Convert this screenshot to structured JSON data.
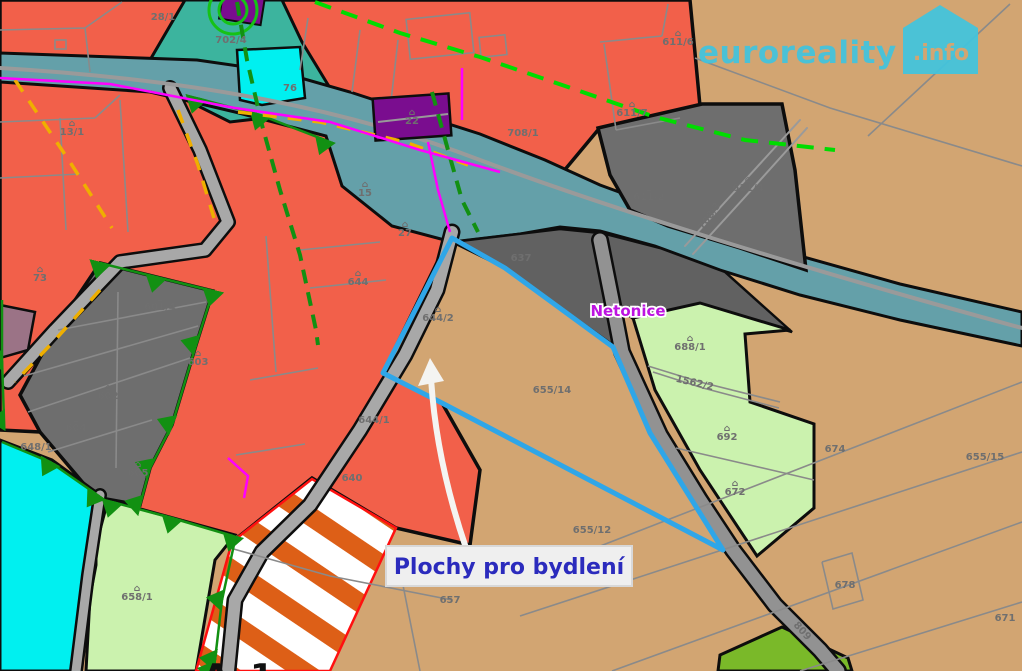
{
  "watermark": {
    "brand": "euroreality",
    "tld": ".info"
  },
  "annotation": {
    "area_label": "Plochy pro bydlení",
    "village_label": "Netonice",
    "zone_code_left": "A",
    "zone_code_right": "1"
  },
  "colors": {
    "housing_red": "#F2604A",
    "field_tan": "#D2A572",
    "gray_zone": "#6E6E6E",
    "stream_teal": "#64A0A9",
    "green_teal": "#3CB49E",
    "light_green": "#CBF2AE",
    "bright_cyan": "#00F0F0",
    "building_purple": "#7A0D8F",
    "lime_green": "#7AB929",
    "highlight_blue": "#2FA6E8",
    "hatch_orange": "#DD5F17",
    "annotation_blue": "#2B2BBD",
    "village_magenta": "#BD13E0",
    "logo_cyan": "#41C4DE"
  },
  "map_labels": [
    {
      "text": "28/1",
      "x": 163,
      "y": 20
    },
    {
      "text": "702/4",
      "x": 231,
      "y": 43,
      "fill": "#519B8C"
    },
    {
      "text": "13/1",
      "x": 72,
      "y": 135,
      "icon": true
    },
    {
      "text": "73",
      "x": 40,
      "y": 281,
      "icon": true
    },
    {
      "text": "76",
      "x": 290,
      "y": 91
    },
    {
      "text": "15",
      "x": 365,
      "y": 196,
      "icon": true
    },
    {
      "text": "27",
      "x": 405,
      "y": 236,
      "icon": true
    },
    {
      "text": "22",
      "x": 412,
      "y": 124,
      "icon": true,
      "fill": "#3d3d3d"
    },
    {
      "text": "708/1",
      "x": 523,
      "y": 136,
      "fill": "#8a8a8a"
    },
    {
      "text": "611/7",
      "x": 632,
      "y": 116,
      "icon": true
    },
    {
      "text": "611/6",
      "x": 678,
      "y": 45,
      "icon": true
    },
    {
      "text": "611/2",
      "x": 649,
      "y": 200,
      "icon": true,
      "fill": "#5d5d5d"
    },
    {
      "text": "611/4",
      "x": 748,
      "y": 191,
      "icon": true,
      "fill": "#5d5d5d"
    },
    {
      "text": "708/3",
      "x": 712,
      "y": 218,
      "rot": -55,
      "fill": "#5d5d5d"
    },
    {
      "text": "637",
      "x": 521,
      "y": 261,
      "fill": "#5d5d5d"
    },
    {
      "text": "644",
      "x": 358,
      "y": 285,
      "icon": true
    },
    {
      "text": "644/2",
      "x": 438,
      "y": 321,
      "icon": true
    },
    {
      "text": "644/1",
      "x": 374,
      "y": 423
    },
    {
      "text": "640",
      "x": 352,
      "y": 481
    },
    {
      "text": "648/1",
      "x": 36,
      "y": 450
    },
    {
      "text": "601/4",
      "x": 160,
      "y": 310,
      "icon": true,
      "fill": "#5d5d5d"
    },
    {
      "text": "603",
      "x": 198,
      "y": 365,
      "icon": true,
      "fill": "#5d5d5d"
    },
    {
      "text": "602",
      "x": 108,
      "y": 399,
      "icon": true,
      "fill": "#5d5d5d"
    },
    {
      "text": "604",
      "x": 76,
      "y": 431,
      "icon": true,
      "fill": "#5d5d5d"
    },
    {
      "text": "605",
      "x": 138,
      "y": 476,
      "icon": true,
      "fill": "#5d5d5d"
    },
    {
      "text": "658/1",
      "x": 137,
      "y": 600,
      "icon": true,
      "fill": "#7a8f6a"
    },
    {
      "text": "688/1",
      "x": 690,
      "y": 350,
      "icon": true,
      "fill": "#7a8f6a"
    },
    {
      "text": "1562/2",
      "x": 694,
      "y": 386,
      "rot": 13,
      "fill": "#7a8f6a"
    },
    {
      "text": "692",
      "x": 727,
      "y": 440,
      "icon": true,
      "fill": "#7a8f6a"
    },
    {
      "text": "672",
      "x": 735,
      "y": 495,
      "icon": true,
      "fill": "#7a8f6a"
    },
    {
      "text": "655/14",
      "x": 552,
      "y": 393,
      "fill": "#8d8d8d"
    },
    {
      "text": "655/12",
      "x": 592,
      "y": 533,
      "fill": "#8d8d8d"
    },
    {
      "text": "657",
      "x": 450,
      "y": 603,
      "fill": "#8d8d8d"
    },
    {
      "text": "674",
      "x": 835,
      "y": 452,
      "fill": "#8d8d8d"
    },
    {
      "text": "655/15",
      "x": 985,
      "y": 460,
      "fill": "#8d8d8d"
    },
    {
      "text": "678",
      "x": 845,
      "y": 588,
      "fill": "#8d8d8d"
    },
    {
      "text": "671",
      "x": 1005,
      "y": 621,
      "fill": "#8d8d8d"
    },
    {
      "text": "809",
      "x": 800,
      "y": 633,
      "rot": 48,
      "fill": "#7d7d7d"
    }
  ]
}
